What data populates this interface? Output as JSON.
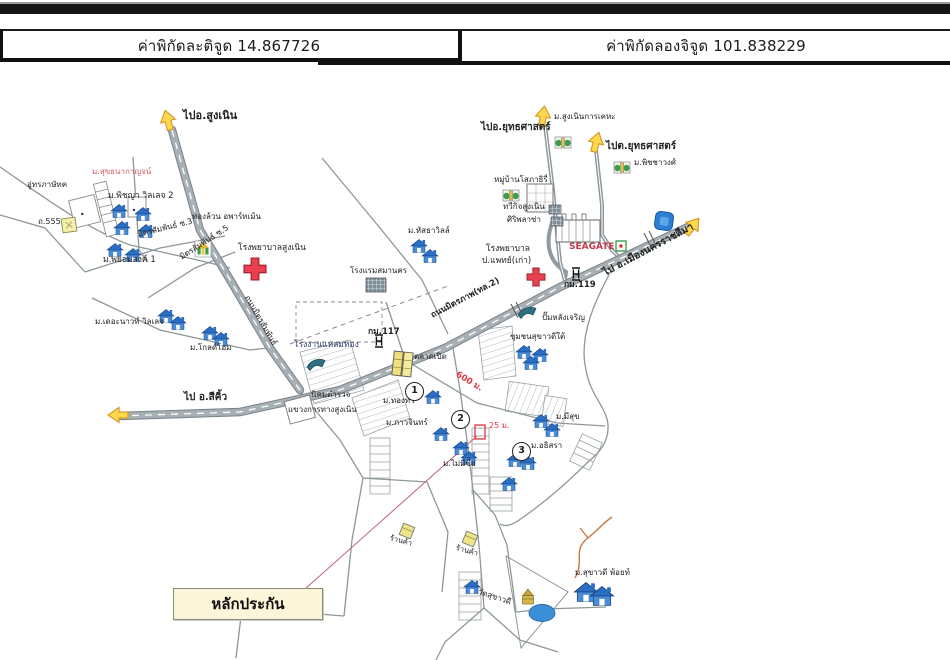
{
  "header": {
    "latitude": "ค่าพิกัดละติจูด 14.867726",
    "longitude": "ค่าพิกัดลองจิจูด 101.838229"
  },
  "map": {
    "collateral_box": {
      "text": "หลักประกัน"
    },
    "accent_colors": {
      "road_gray": "#9fa8ad",
      "house_blue": "#2b6fc4",
      "arrow_yellow": "#ffd94d",
      "cross_red": "#e8404e",
      "seagate_red": "#c2374a",
      "distance_red": "#e0343c"
    },
    "labels": [
      {
        "id": "to-sung-noen",
        "text": "ไปอ.สูงเนิน",
        "x": 183,
        "y": 110,
        "size": 11,
        "bold": 1
      },
      {
        "id": "suk-thana-kanchana-village",
        "text": "ม.สุขธนากาญจน์",
        "x": 92,
        "y": 168,
        "size": 8,
        "color": "#d4606a"
      },
      {
        "id": "garage",
        "text": "อู่ทรภาษัทค",
        "x": 27,
        "y": 181,
        "size": 8
      },
      {
        "id": "road-555",
        "text": "ถ.555",
        "x": 38,
        "y": 218,
        "size": 8
      },
      {
        "id": "phitchaya-village-2",
        "text": "ม.พิชญา วิลเลจ 2",
        "x": 108,
        "y": 192,
        "size": 8.5
      },
      {
        "id": "phayom-song-1",
        "text": "ม.พยอมสงค์ 1",
        "x": 103,
        "y": 256,
        "size": 8.5
      },
      {
        "id": "thongluan-apartment",
        "text": "ทองล้วน อพาร์ทเม้น",
        "x": 192,
        "y": 213,
        "size": 8
      },
      {
        "id": "mitsamphan-soi-3",
        "text": "มิตรสัมพันธ์ ซ.3",
        "x": 138,
        "y": 231,
        "rot": -14,
        "size": 8
      },
      {
        "id": "mitsamphan-soi-5",
        "text": "มิตรสัมพันธ์ ซ.5",
        "x": 181,
        "y": 254,
        "rot": -33,
        "size": 8
      },
      {
        "id": "sungnoen-hospital",
        "text": "โรงพยาบาลสูงเนิน",
        "x": 238,
        "y": 244,
        "size": 8.5
      },
      {
        "id": "mitsamphan-road",
        "text": "ถนนมิตรสัมพันธ์",
        "x": 246,
        "y": 292,
        "rot": 60,
        "size": 8
      },
      {
        "id": "to-yutthasat-1",
        "text": "ไปอ.ยุทธศาสตร์",
        "x": 481,
        "y": 122,
        "size": 10,
        "bold": 1
      },
      {
        "id": "sungnoen-kankheha",
        "text": "ม.สูงเนินการเคหะ",
        "x": 554,
        "y": 113,
        "size": 8
      },
      {
        "id": "to-yutthasat-2",
        "text": "ไปต.ยุทธศาสตร์",
        "x": 606,
        "y": 141,
        "size": 10,
        "bold": 1
      },
      {
        "id": "phitchawong-village",
        "text": "ม.พิชชาวงศ์",
        "x": 634,
        "y": 159,
        "size": 8
      },
      {
        "id": "sophathiri-village",
        "text": "หมู่บ้านโสภาธิรี่",
        "x": 494,
        "y": 176,
        "size": 8
      },
      {
        "id": "taweekit-sungnoen",
        "text": "ทวีกิจสูงเนิน",
        "x": 503,
        "y": 203,
        "size": 8
      },
      {
        "id": "siri-plaza",
        "text": "ศิริพลาซ่า",
        "x": 507,
        "y": 216,
        "size": 8
      },
      {
        "id": "seagate",
        "text": "SEAGATE",
        "x": 569,
        "y": 243,
        "size": 9,
        "bold": 1,
        "color": "#c2374a"
      },
      {
        "id": "po-phaet-hospital-line1",
        "text": "โรงพยาบาล",
        "x": 486,
        "y": 245,
        "size": 8.5
      },
      {
        "id": "po-phaet-hospital-line2",
        "text": "ป.แพทย์(เก่า)",
        "x": 482,
        "y": 257,
        "size": 8.5
      },
      {
        "id": "km-119",
        "text": "กม.119",
        "x": 564,
        "y": 281,
        "size": 8.5,
        "bold": 1
      },
      {
        "id": "to-nakhon-ratchasima",
        "text": "ไป อ.เมืองนครราชสีมา",
        "x": 604,
        "y": 268,
        "rot": -28,
        "size": 10,
        "bold": 1
      },
      {
        "id": "hatsatha-ville",
        "text": "ม.หัสธาวิลล์",
        "x": 408,
        "y": 227,
        "size": 8
      },
      {
        "id": "samankorn-hotel",
        "text": "โรงแรมสมานคร",
        "x": 350,
        "y": 267,
        "size": 8
      },
      {
        "id": "mittraphap-road",
        "text": "ถนนมิตรภาพ(ทล.2)",
        "x": 432,
        "y": 312,
        "rot": -28,
        "size": 8.5,
        "bold": 1
      },
      {
        "id": "lang-charoen-pump",
        "text": "ปั๊มหลังเจริญ",
        "x": 542,
        "y": 314,
        "size": 8
      },
      {
        "id": "sukhavadee-south-community",
        "text": "ชุมชนสุขาวดีใต้",
        "x": 510,
        "y": 333,
        "size": 8
      },
      {
        "id": "km-117",
        "text": "กม.117",
        "x": 368,
        "y": 328,
        "size": 8.5,
        "bold": 1
      },
      {
        "id": "laemthong-factory",
        "text": "โรงงานแหลมทอง",
        "x": 294,
        "y": 341,
        "size": 8.5,
        "color": "#2c3e6b"
      },
      {
        "id": "talad-perd",
        "text": "ตลาดเปิด",
        "x": 414,
        "y": 353,
        "size": 8
      },
      {
        "id": "distance-600m",
        "text": "600 ม.",
        "x": 456,
        "y": 370,
        "rot": 31,
        "size": 8.5,
        "bold": 1,
        "color": "#e0343c"
      },
      {
        "id": "police-housing",
        "text": "นิคมตำรวจ",
        "x": 311,
        "y": 391,
        "size": 8
      },
      {
        "id": "sungnoen-highway-district",
        "text": "แขวงการทางสูงเนิน",
        "x": 288,
        "y": 406,
        "size": 8
      },
      {
        "id": "to-sikhio",
        "text": "ไป อ.สีคิ้ว",
        "x": 184,
        "y": 392,
        "size": 10,
        "bold": 1
      },
      {
        "id": "the-nawat-village",
        "text": "ม.เดอะนาวท์ วิลเลจ",
        "x": 95,
        "y": 318,
        "size": 8
      },
      {
        "id": "gold-home-village",
        "text": "ม.โกลด์โฮม",
        "x": 190,
        "y": 344,
        "size": 8
      },
      {
        "id": "thong-thawee-village",
        "text": "ม.ทองทวี",
        "x": 383,
        "y": 397,
        "size": 8
      },
      {
        "id": "phawachin-village",
        "text": "ม.ภาวจินทร์",
        "x": 386,
        "y": 419,
        "size": 8
      },
      {
        "id": "distance-25m",
        "text": "25 ม.",
        "x": 489,
        "y": 422,
        "size": 8,
        "color": "#e0343c"
      },
      {
        "id": "no-name-village",
        "text": "ม.ไม่มีชื่อ",
        "x": 443,
        "y": 460,
        "size": 8
      },
      {
        "id": "meesuk-village",
        "text": "ม.มีสุข",
        "x": 556,
        "y": 413,
        "size": 8
      },
      {
        "id": "athisara-village",
        "text": "ม.อธิสรา",
        "x": 531,
        "y": 442,
        "size": 8
      },
      {
        "id": "shop-1",
        "text": "ร้านค้า",
        "x": 390,
        "y": 534,
        "rot": 15,
        "size": 7.5
      },
      {
        "id": "shop-2",
        "text": "ร้านค้า",
        "x": 456,
        "y": 544,
        "rot": 15,
        "size": 7.5
      },
      {
        "id": "wat-sukhavadee",
        "text": "วัดสุขาวดี",
        "x": 478,
        "y": 588,
        "rot": 18,
        "size": 8
      },
      {
        "id": "sukhavadee-point-village",
        "text": "ม.สุขาวดี พ้อยท์",
        "x": 575,
        "y": 569,
        "size": 8
      }
    ],
    "circles": [
      {
        "n": "1",
        "x": 414,
        "y": 391
      },
      {
        "n": "2",
        "x": 460,
        "y": 419
      },
      {
        "n": "3",
        "x": 521,
        "y": 451
      }
    ],
    "houses": [
      [
        119,
        211
      ],
      [
        143,
        214
      ],
      [
        122,
        228
      ],
      [
        146,
        231
      ],
      [
        115,
        250
      ],
      [
        133,
        255
      ],
      [
        166,
        316
      ],
      [
        178,
        323
      ],
      [
        210,
        333
      ],
      [
        221,
        339
      ],
      [
        419,
        246
      ],
      [
        430,
        256
      ],
      [
        524,
        352
      ],
      [
        540,
        355
      ],
      [
        531,
        363
      ],
      [
        433,
        397
      ],
      [
        441,
        434
      ],
      [
        461,
        448
      ],
      [
        469,
        458
      ],
      [
        515,
        460
      ],
      [
        528,
        463
      ],
      [
        509,
        484
      ],
      [
        541,
        421
      ],
      [
        552,
        430
      ],
      [
        472,
        587
      ],
      [
        586,
        592,
        1.45
      ],
      [
        602,
        596,
        1.45
      ]
    ],
    "icons": [
      {
        "type": "direction-arrow",
        "x": 168,
        "y": 121,
        "rot": -15
      },
      {
        "type": "direction-arrow",
        "x": 543,
        "y": 117,
        "rot": 8
      },
      {
        "type": "direction-arrow",
        "x": 596,
        "y": 143,
        "rot": 15
      },
      {
        "type": "direction-arrow",
        "x": 692,
        "y": 227,
        "rot": 38
      },
      {
        "type": "direction-arrow",
        "x": 119,
        "y": 415,
        "rot": -90
      },
      {
        "type": "hospital-cross",
        "x": 255,
        "y": 269,
        "scale": 1.1
      },
      {
        "type": "hospital-cross",
        "x": 536,
        "y": 277,
        "scale": 0.9
      },
      {
        "type": "km-marker",
        "x": 379,
        "y": 341
      },
      {
        "type": "km-marker",
        "x": 576,
        "y": 274
      },
      {
        "type": "fuel-swoosh",
        "x": 316,
        "y": 364
      },
      {
        "type": "fuel-swoosh",
        "x": 527,
        "y": 312
      },
      {
        "type": "blue-landmark",
        "x": 664,
        "y": 221,
        "rot": 8
      },
      {
        "type": "road-sign-green",
        "x": 621,
        "y": 246
      },
      {
        "type": "shrine",
        "x": 203,
        "y": 249
      },
      {
        "type": "sign-555",
        "x": 69,
        "y": 225
      },
      {
        "type": "market",
        "x": 403,
        "y": 364,
        "rot": 6
      },
      {
        "type": "shop",
        "x": 407,
        "y": 531,
        "rot": 10
      },
      {
        "type": "shop",
        "x": 470,
        "y": 539,
        "rot": 10
      },
      {
        "type": "temple",
        "x": 528,
        "y": 599
      },
      {
        "type": "pond",
        "x": 542,
        "y": 613
      },
      {
        "type": "green-building",
        "x": 563,
        "y": 143
      },
      {
        "type": "green-building",
        "x": 511,
        "y": 196
      },
      {
        "type": "green-building",
        "x": 622,
        "y": 168
      }
    ]
  }
}
